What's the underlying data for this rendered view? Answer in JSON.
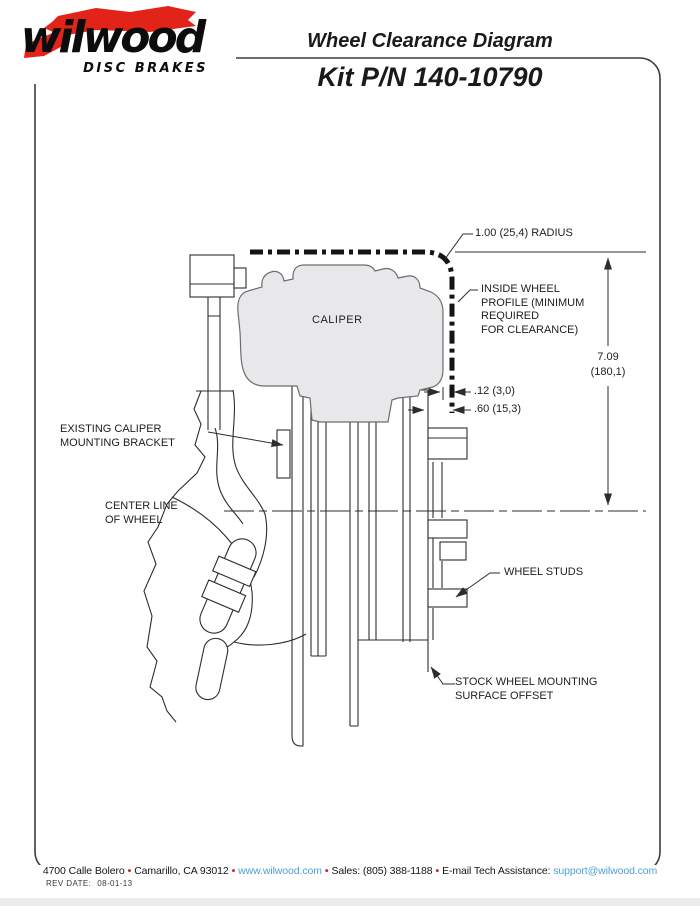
{
  "header": {
    "logo": {
      "brand": "wilwood",
      "tagline": "DISC BRAKES"
    },
    "title": "Wheel Clearance Diagram",
    "subtitle": "Kit P/N 140-10790"
  },
  "diagram": {
    "labels": {
      "radius": "1.00 (25,4) RADIUS",
      "inside_wheel": [
        "INSIDE WHEEL",
        "PROFILE (MINIMUM",
        "REQUIRED",
        "FOR CLEARANCE)"
      ],
      "caliper": "CALIPER",
      "height_dim": [
        "7.09",
        "(180,1)"
      ],
      "gap_dim_1": ".12 (3,0)",
      "gap_dim_2": ".60 (15,3)",
      "bracket": [
        "EXISTING CALIPER",
        "MOUNTING BRACKET"
      ],
      "centerline": [
        "CENTER LINE",
        "OF WHEEL"
      ],
      "studs": "WHEEL STUDS",
      "offset": [
        "STOCK WHEEL MOUNTING",
        "SURFACE OFFSET"
      ]
    }
  },
  "footer": {
    "address": "4700 Calle Bolero",
    "bullet": "•",
    "city": "Camarillo, CA 93012",
    "website": "www.wilwood.com",
    "sales": "Sales: (805) 388-1188",
    "email_label": "E-mail Tech Assistance:",
    "email": "support@wilwood.com",
    "rev_label": "REV DATE:",
    "rev_date": "08-01-13"
  },
  "colors": {
    "brand_red": "#e2231a",
    "link_blue": "#4aa0d8",
    "bullet_red": "#c5281c",
    "caliper_fill": "#e8e8ea",
    "line": "#2d2d2d"
  }
}
